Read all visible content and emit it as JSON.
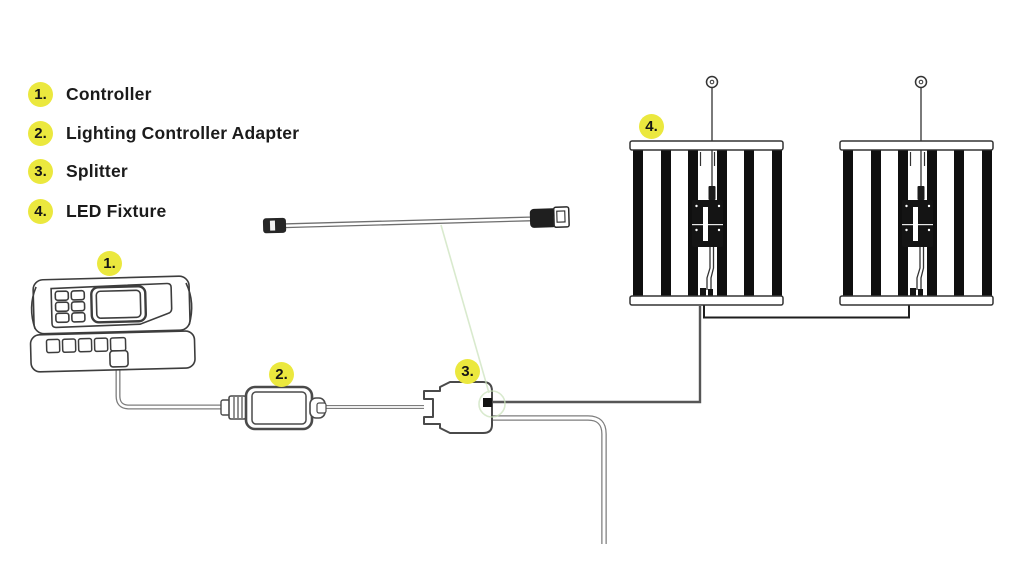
{
  "page": {
    "background_color": "#ffffff"
  },
  "legend": {
    "items": [
      {
        "num": "1.",
        "label": "Controller"
      },
      {
        "num": "2.",
        "label": "Lighting Controller Adapter"
      },
      {
        "num": "3.",
        "label": "Splitter"
      },
      {
        "num": "4.",
        "label": "LED Fixture"
      }
    ]
  },
  "diagram": {
    "callouts": [
      "1.",
      "2.",
      "3.",
      "4."
    ],
    "colors": {
      "badge_yellow": "#ebe83e",
      "line_art": "#3d3d3d",
      "cable_gray": "#7d7d7d",
      "annotation_green": "#c9e2ba",
      "component_black": "#141414"
    }
  }
}
